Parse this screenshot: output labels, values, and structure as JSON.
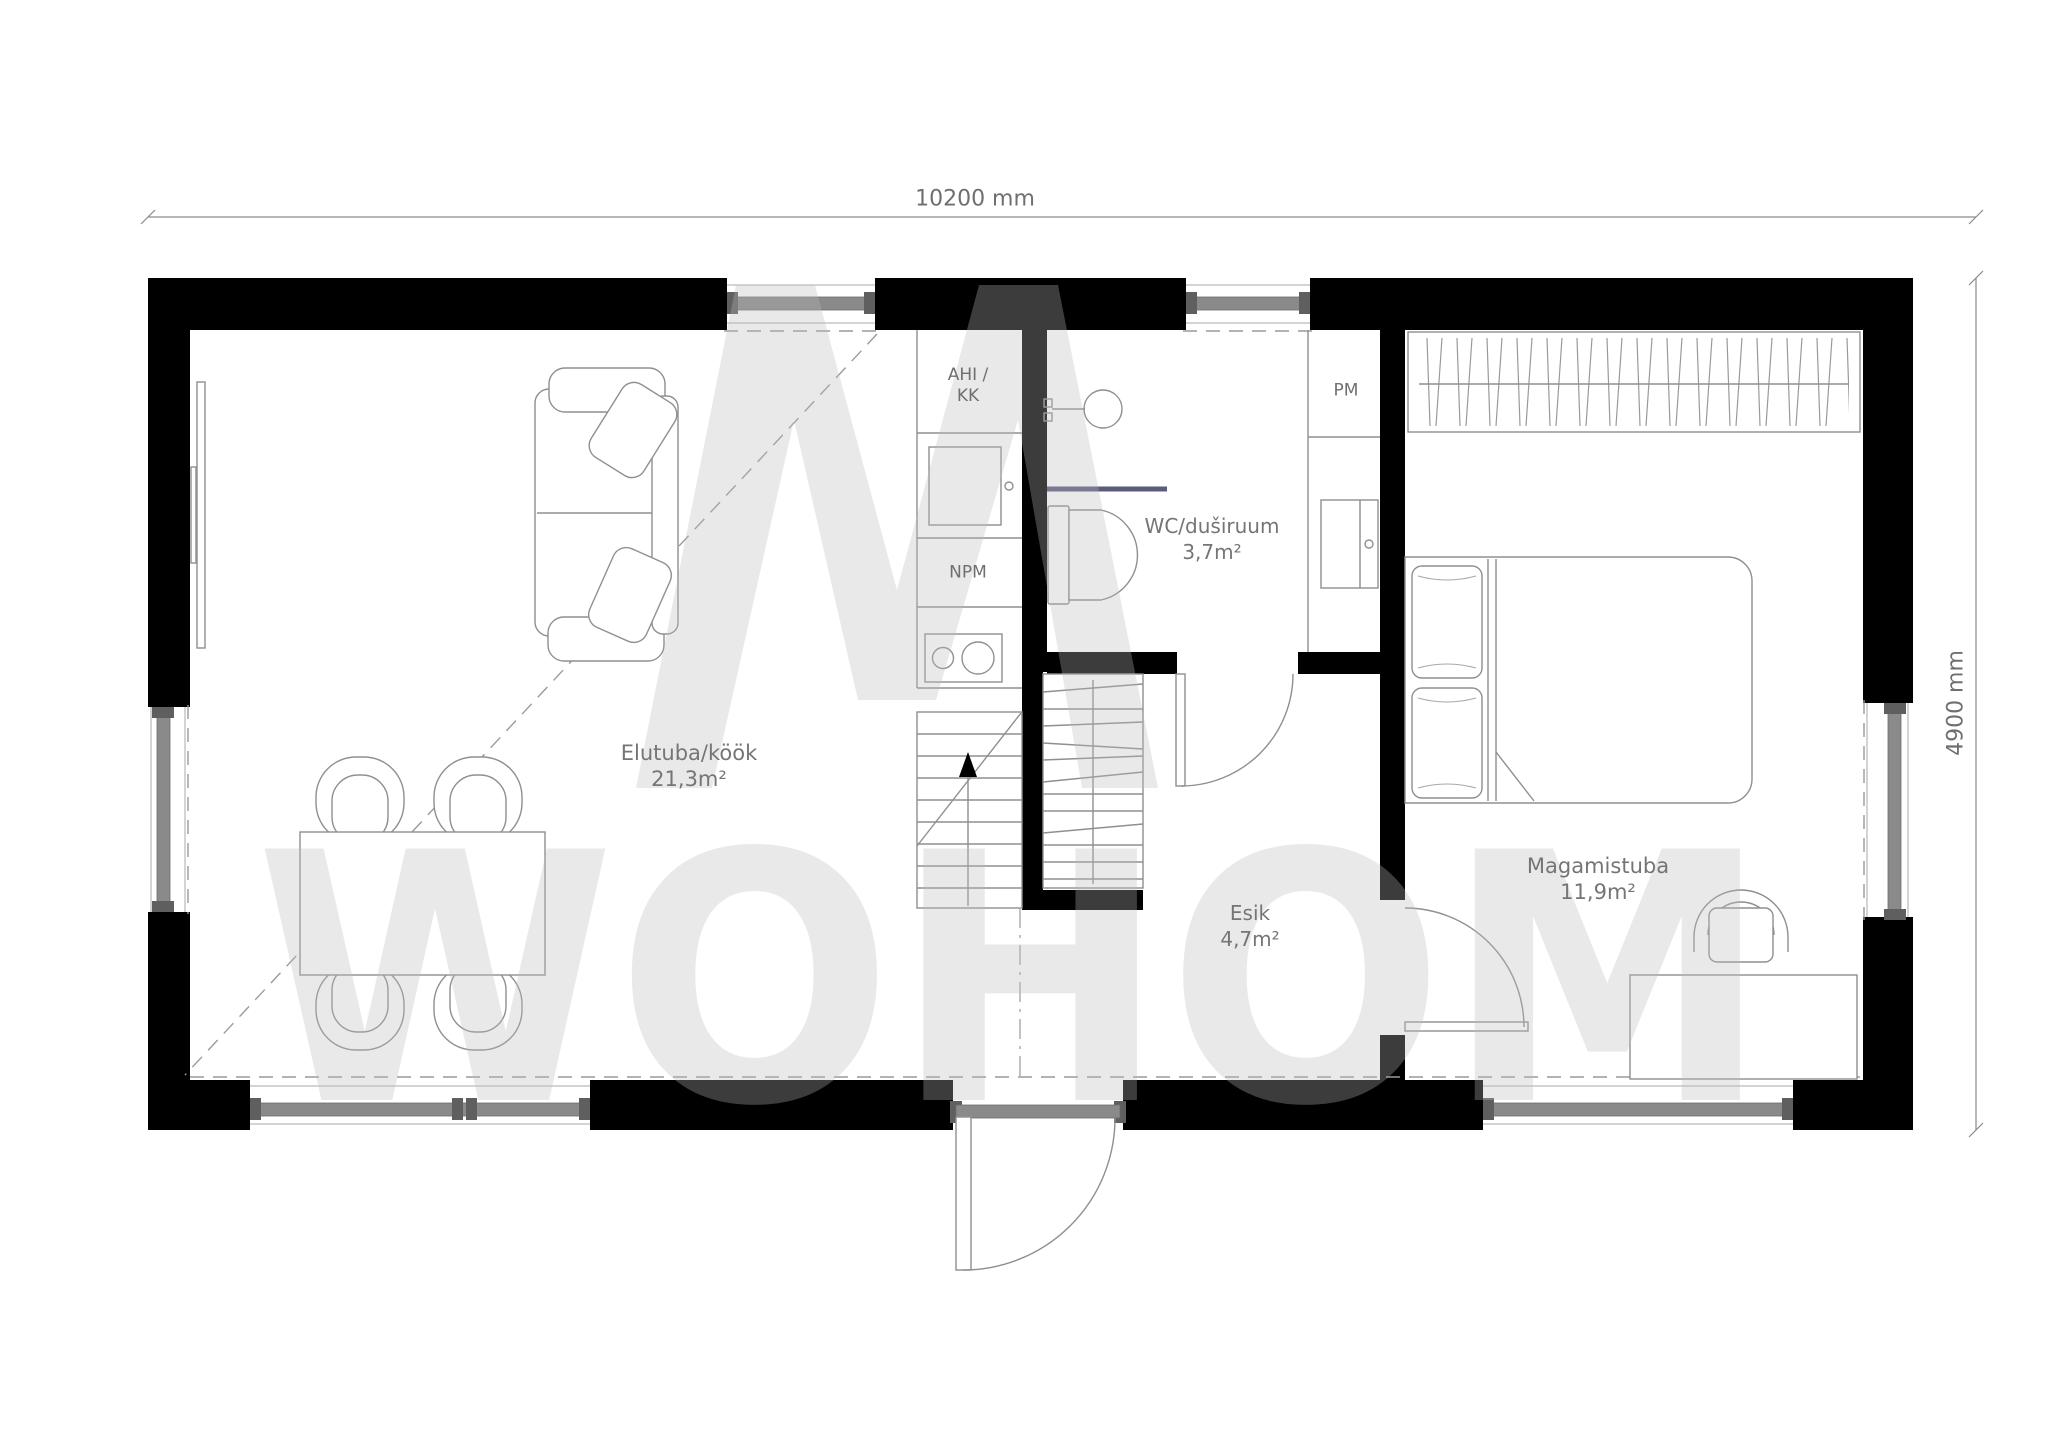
{
  "plan": {
    "dimensions": {
      "width_label": "10200 mm",
      "height_label": "4900 mm"
    },
    "rooms": {
      "living": {
        "name": "Elutuba/köök",
        "area": "21,3m²"
      },
      "bathroom": {
        "name": "WC/duširuum",
        "area": "3,7m²"
      },
      "hallway": {
        "name": "Esik",
        "area": "4,7m²"
      },
      "bedroom": {
        "name": "Magamistuba",
        "area": "11,9m²"
      }
    },
    "appliance_labels": {
      "oven_line1": "AHI /",
      "oven_line2": "KK",
      "dishwasher": "NPM",
      "washing_machine": "PM"
    },
    "watermark": {
      "text": "WOHOM"
    },
    "colors": {
      "wall": "#000000",
      "outline": "#8f8f8f",
      "window_bar": "#8a8a8a",
      "window_cap": "#5f5f5f",
      "label_text": "#757575",
      "shower_screen": "#5b5b7e",
      "watermark": "#bababa"
    }
  }
}
